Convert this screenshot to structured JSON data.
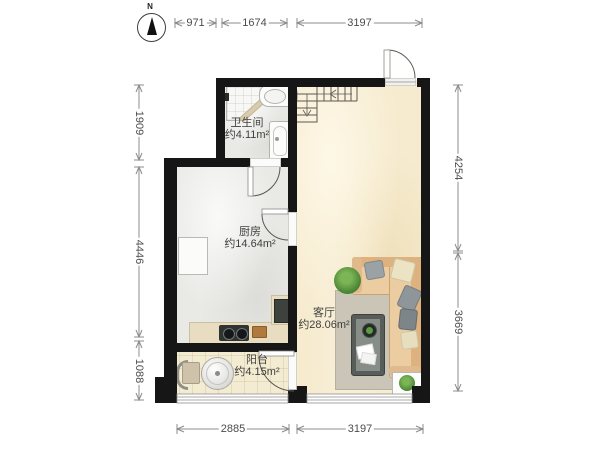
{
  "compass": {
    "label": "N"
  },
  "rooms": [
    {
      "id": "bathroom",
      "name": "卫生间",
      "area": "约4.11m²"
    },
    {
      "id": "kitchen",
      "name": "厨房",
      "area": "约14.64m²"
    },
    {
      "id": "living-room",
      "name": "客厅",
      "area": "约28.06m²"
    },
    {
      "id": "balcony",
      "name": "阳台",
      "area": "约4.15m²"
    }
  ],
  "dimensions": {
    "top": [
      {
        "label": "971"
      },
      {
        "label": "1674"
      },
      {
        "label": "3197"
      }
    ],
    "bottom": [
      {
        "label": "2885"
      },
      {
        "label": "3197"
      }
    ],
    "left": [
      {
        "label": "1909"
      },
      {
        "label": "4446"
      },
      {
        "label": "1088"
      }
    ],
    "right": [
      {
        "label": "4254"
      },
      {
        "label": "3669"
      }
    ]
  },
  "fixtures": [
    "shower",
    "toilet",
    "bathtub",
    "kitchen-cabinet",
    "kitchen-counter",
    "stove",
    "cutting-board",
    "fridge",
    "staircase",
    "entry-door",
    "bathroom-door",
    "kitchen-door",
    "balcony-door",
    "sofa",
    "rug",
    "coffee-table",
    "potted-plant",
    "planter-box",
    "washing-machine",
    "balcony-chair",
    "window"
  ],
  "colors": {
    "wall": "#161616",
    "living_floor": "#f6ebcf",
    "kitchen_floor": "#e9e9e6",
    "balcony_floor": "#f4ecd2",
    "sofa": "#ecca9e",
    "rug": "#cbc5b8",
    "plant": "#4e8f3a",
    "dimension_text": "#4c4c4c"
  }
}
